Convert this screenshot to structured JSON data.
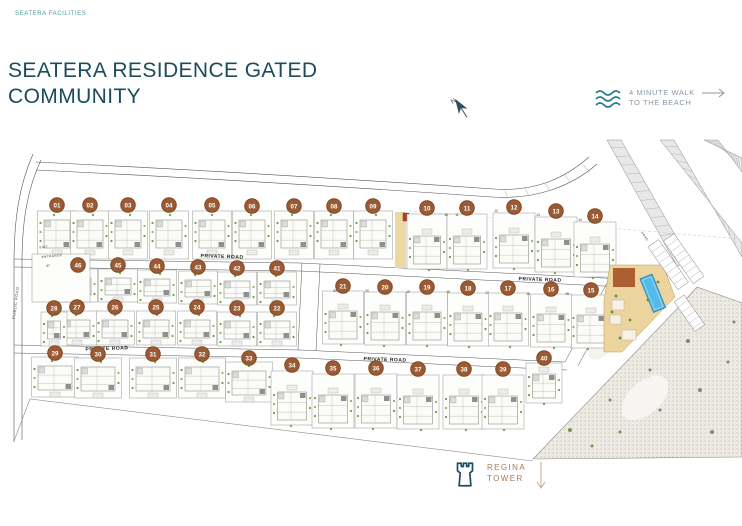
{
  "header": {
    "brand": "SEATERA FACILITIES",
    "title_line1": "SEATERA RESIDENCE GATED",
    "title_line2": "COMMUNITY",
    "title_color": "#1b4b5c"
  },
  "north": {
    "label": "N"
  },
  "beach": {
    "line1": "4 MINUTE WALK",
    "line2": "TO THE BEACH",
    "icon": "waves-icon",
    "arrow_icon": "arrow-right-icon",
    "text_color": "#8b97a3",
    "wave_color": "#2a7f8e"
  },
  "regina": {
    "line1": "REGINA",
    "line2": "TOWER",
    "icon": "tower-icon",
    "arrow_icon": "arrow-down-icon",
    "text_color": "#a57a56"
  },
  "site_plan": {
    "colors": {
      "circle_fill": "#9a5a33",
      "circle_ring": "#7b441f",
      "circle_text": "#ffffff",
      "road_line": "#555555",
      "plot_fill": "#fdfdfb",
      "tree_green": "#6d9e4a",
      "pool_blue": "#54bbe9",
      "deck_brown": "#ad5f32",
      "amenity_tan": "#ecd49e",
      "road_tint": "#ecd9a2",
      "marker_red": "#b2402e"
    },
    "plots": [
      {
        "n": "01",
        "x": 57,
        "y": 205
      },
      {
        "n": "02",
        "x": 90,
        "y": 205
      },
      {
        "n": "03",
        "x": 128,
        "y": 205
      },
      {
        "n": "04",
        "x": 169,
        "y": 205
      },
      {
        "n": "05",
        "x": 212,
        "y": 205
      },
      {
        "n": "06",
        "x": 252,
        "y": 206
      },
      {
        "n": "07",
        "x": 294,
        "y": 206
      },
      {
        "n": "08",
        "x": 334,
        "y": 206
      },
      {
        "n": "09",
        "x": 373,
        "y": 206
      },
      {
        "n": "10",
        "x": 427,
        "y": 208
      },
      {
        "n": "11",
        "x": 467,
        "y": 208
      },
      {
        "n": "12",
        "x": 514,
        "y": 207
      },
      {
        "n": "13",
        "x": 556,
        "y": 211
      },
      {
        "n": "14",
        "x": 595,
        "y": 216
      },
      {
        "n": "15",
        "x": 591,
        "y": 290
      },
      {
        "n": "16",
        "x": 551,
        "y": 289
      },
      {
        "n": "17",
        "x": 508,
        "y": 288
      },
      {
        "n": "18",
        "x": 468,
        "y": 288
      },
      {
        "n": "19",
        "x": 427,
        "y": 287
      },
      {
        "n": "20",
        "x": 385,
        "y": 287
      },
      {
        "n": "21",
        "x": 343,
        "y": 286
      },
      {
        "n": "22",
        "x": 277,
        "y": 308
      },
      {
        "n": "23",
        "x": 237,
        "y": 308
      },
      {
        "n": "24",
        "x": 197,
        "y": 307
      },
      {
        "n": "25",
        "x": 156,
        "y": 307
      },
      {
        "n": "26",
        "x": 115,
        "y": 307
      },
      {
        "n": "27",
        "x": 77,
        "y": 307
      },
      {
        "n": "28",
        "x": 54,
        "y": 308
      },
      {
        "n": "29",
        "x": 55,
        "y": 353
      },
      {
        "n": "30",
        "x": 98,
        "y": 354
      },
      {
        "n": "31",
        "x": 153,
        "y": 354
      },
      {
        "n": "32",
        "x": 202,
        "y": 354
      },
      {
        "n": "33",
        "x": 249,
        "y": 358
      },
      {
        "n": "34",
        "x": 292,
        "y": 365
      },
      {
        "n": "35",
        "x": 333,
        "y": 368
      },
      {
        "n": "36",
        "x": 376,
        "y": 368
      },
      {
        "n": "37",
        "x": 418,
        "y": 369
      },
      {
        "n": "38",
        "x": 464,
        "y": 369
      },
      {
        "n": "39",
        "x": 503,
        "y": 369
      },
      {
        "n": "40",
        "x": 544,
        "y": 358
      },
      {
        "n": "41",
        "x": 277,
        "y": 268
      },
      {
        "n": "42",
        "x": 237,
        "y": 268
      },
      {
        "n": "43",
        "x": 198,
        "y": 267
      },
      {
        "n": "44",
        "x": 157,
        "y": 266
      },
      {
        "n": "45",
        "x": 118,
        "y": 265
      },
      {
        "n": "46",
        "x": 78,
        "y": 265
      }
    ],
    "road_labels": [
      {
        "t": "PRIVATE ROAD",
        "x": 222,
        "y": 258,
        "r": 2,
        "s": 5
      },
      {
        "t": "PRIVATE ROAD",
        "x": 540,
        "y": 281,
        "r": 2,
        "s": 5
      },
      {
        "t": "PRIVATE ROAD",
        "x": 107,
        "y": 350,
        "r": -2,
        "s": 5
      },
      {
        "t": "PRIVATE ROAD",
        "x": 385,
        "y": 361,
        "r": 2,
        "s": 5
      },
      {
        "t": "PUBLIC ROAD",
        "x": 17,
        "y": 303,
        "r": -83,
        "s": 4
      },
      {
        "t": "ENTRANCE",
        "x": 52,
        "y": 257,
        "r": -6,
        "s": 3
      },
      {
        "t": "EXIT",
        "x": 44,
        "y": 248,
        "r": -6,
        "s": 3
      },
      {
        "t": "ROAD",
        "x": 644,
        "y": 237,
        "r": 55,
        "s": 3
      }
    ],
    "corner_numbers": [
      {
        "t": "10",
        "x": 446,
        "y": 216
      },
      {
        "t": "11",
        "x": 457,
        "y": 216
      },
      {
        "t": "12",
        "x": 496,
        "y": 212
      },
      {
        "t": "13",
        "x": 538,
        "y": 216
      },
      {
        "t": "14",
        "x": 580,
        "y": 221
      },
      {
        "t": "21",
        "x": 335,
        "y": 292
      },
      {
        "t": "20",
        "x": 367,
        "y": 292
      },
      {
        "t": "19",
        "x": 408,
        "y": 293
      },
      {
        "t": "18",
        "x": 448,
        "y": 293
      },
      {
        "t": "17",
        "x": 487,
        "y": 294
      },
      {
        "t": "16",
        "x": 528,
        "y": 295
      },
      {
        "t": "15",
        "x": 567,
        "y": 295
      },
      {
        "t": "47",
        "x": 48,
        "y": 267
      }
    ]
  }
}
